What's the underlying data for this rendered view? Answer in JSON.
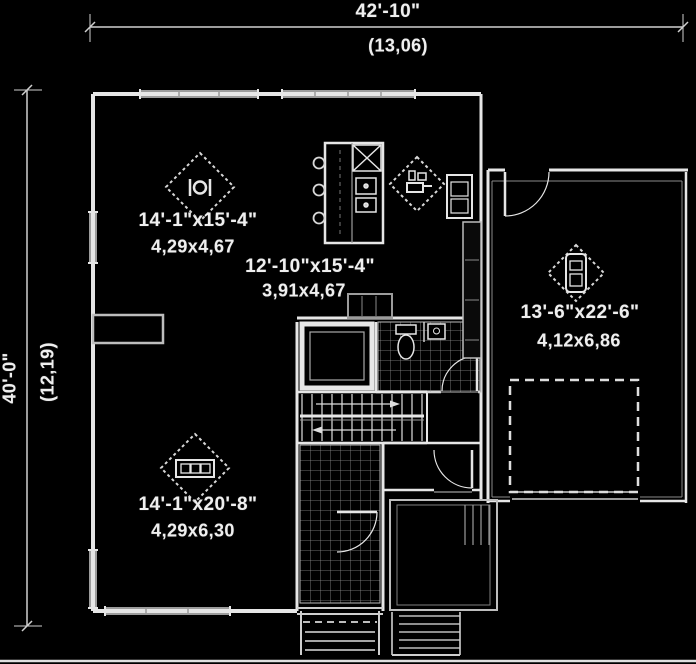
{
  "colors": {
    "background": "#000000",
    "wall": "#e6e6e6",
    "window": "#9c9c9c",
    "dimension_line": "#cfcfcf",
    "text": "#efefef"
  },
  "plan": {
    "type": "floor-plan",
    "dimensions": {
      "top": {
        "imperial": "42'-10\"",
        "metric": "(13,06)"
      },
      "left": {
        "imperial": "40'-0\"",
        "metric": "(12,19)"
      }
    },
    "rooms": {
      "dining": {
        "imperial": "14'-1\"x15'-4\"",
        "metric": "4,29x4,67",
        "icon": "dining-table-icon"
      },
      "kitchen": {
        "imperial": "12'-10\"x15'-4\"",
        "metric": "3,91x4,67",
        "icon": "cooktop-icon"
      },
      "garage": {
        "imperial": "13'-6\"x22'-6\"",
        "metric": "4,12x6,86",
        "icon": "car-icon"
      },
      "living": {
        "imperial": "14'-1\"x20'-8\"",
        "metric": "4,29x6,30",
        "icon": "sofa-icon"
      }
    }
  }
}
